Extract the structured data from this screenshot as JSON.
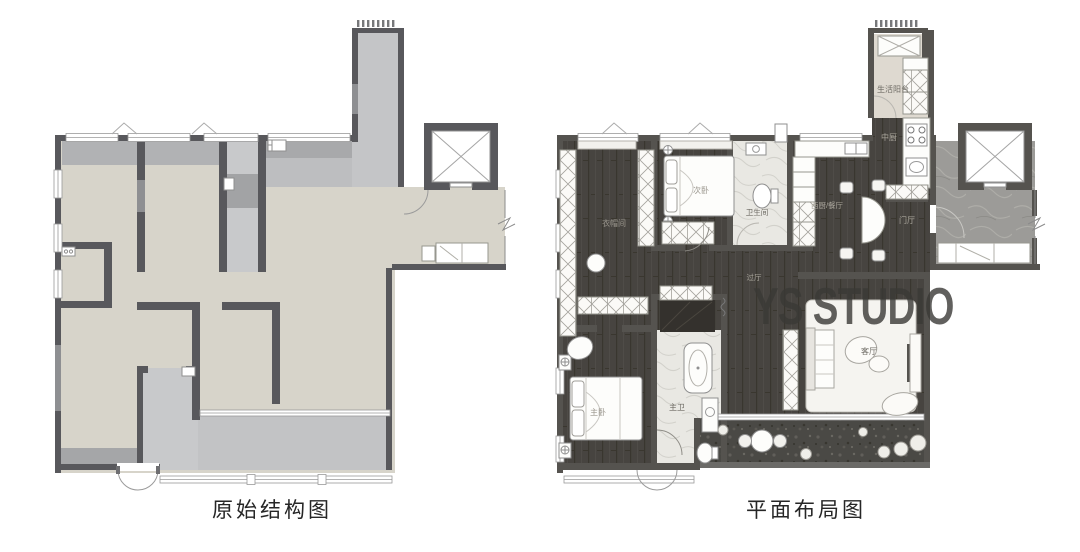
{
  "captions": {
    "left": "原始结构图",
    "right": "平面布局图"
  },
  "watermark": {
    "text": "YS STUDIO"
  },
  "rooms": {
    "life_balcony": "生活阳台",
    "chinese_kitchen": "中厨",
    "second_bedroom": "次卧",
    "bathroom": "卫生间",
    "western_kitchen_dining": "西厨/餐厅",
    "foyer": "门厅",
    "walk_in_closet": "衣帽间",
    "hallway": "过厅",
    "living_room": "客厅",
    "master_bedroom": "主卧",
    "master_bathroom": "主卫"
  },
  "colors": {
    "wall_dark": "#58585c",
    "wall_light": "#8e8f92",
    "floor_beige": "#d7d4ca",
    "floor_gray": "#c6c7c9",
    "wood_dark": "#474440",
    "marble_light": "#e9e8e3",
    "marble_gray": "#9c9b98",
    "watermark_gray": "#3a3936"
  }
}
